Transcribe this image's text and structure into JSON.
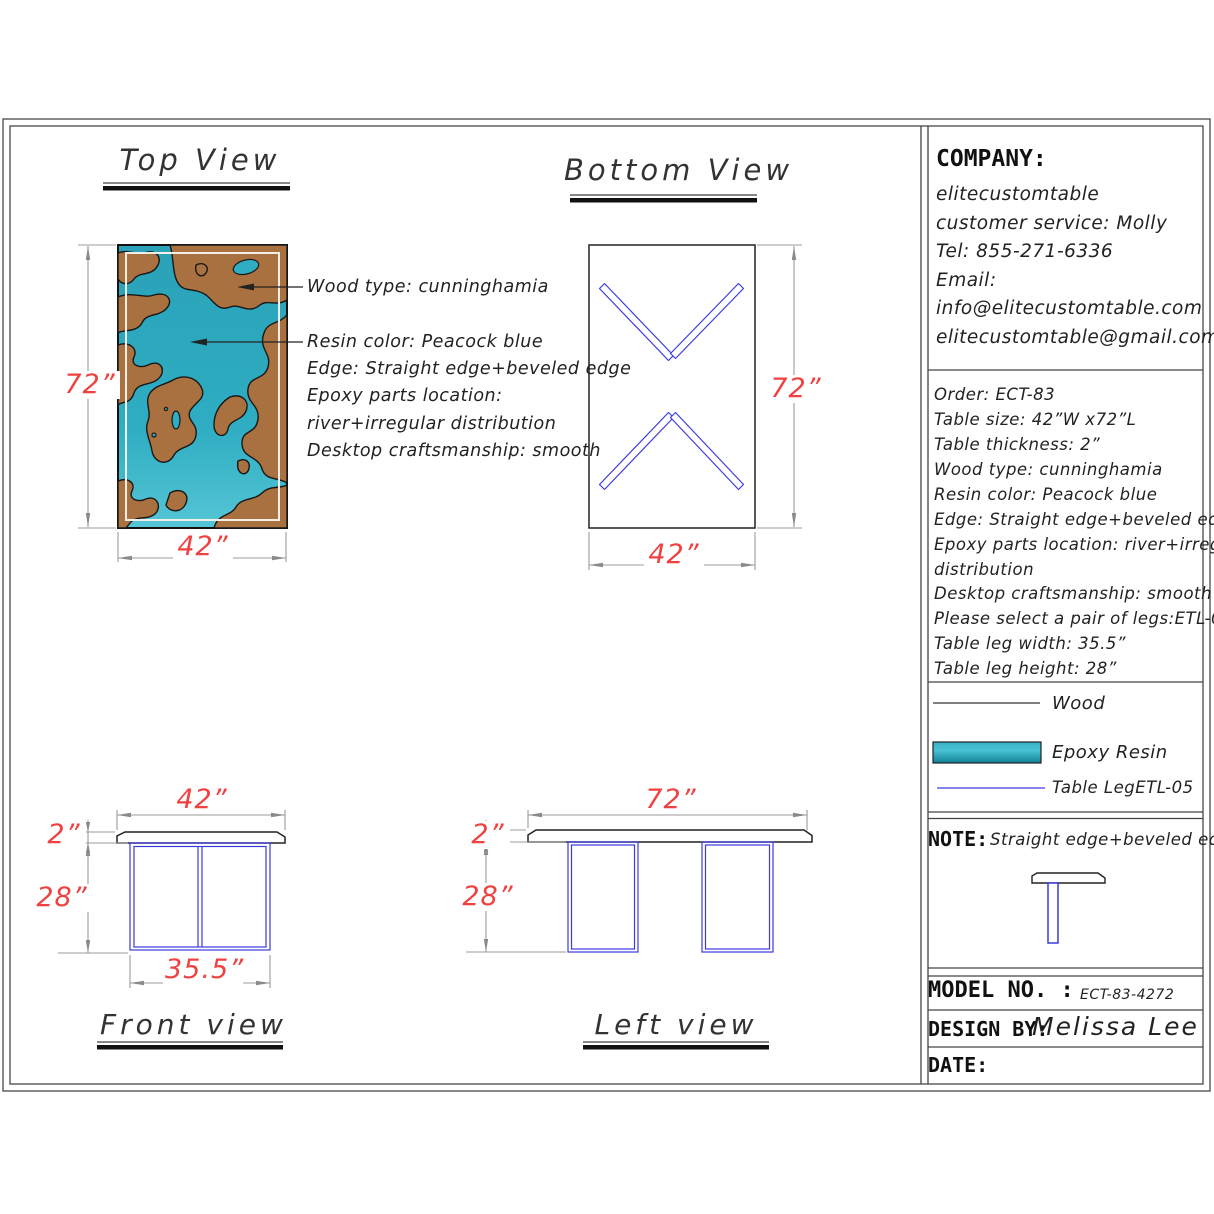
{
  "titles": {
    "top_view": "Top View",
    "bottom_view": "Bottom View",
    "front_view": "Front view",
    "left_view": "Left view"
  },
  "annotations": {
    "wood": "Wood type: cunninghamia",
    "lines": [
      "Resin color: Peacock blue",
      "Edge: Straight edge+beveled edge",
      "Epoxy parts location:",
      "river+irregular distribution",
      "Desktop craftsmanship: smooth"
    ]
  },
  "dims": {
    "top_view": {
      "length": "72”",
      "width": "42”"
    },
    "bottom_view": {
      "length": "72”",
      "width": "42”"
    },
    "front_view": {
      "width": "42”",
      "thickness": "2”",
      "leg_height": "28”",
      "leg_width": "35.5”"
    },
    "left_view": {
      "length": "72”",
      "thickness": "2”",
      "leg_height": "28”"
    }
  },
  "company": {
    "label": "COMPANY:",
    "name": "elitecustomtable",
    "service": "customer service: Molly",
    "tel": "Tel: 855-271-6336",
    "email_label": "Email:",
    "email1": "info@elitecustomtable.com",
    "email2": "elitecustomtable@gmail.com"
  },
  "order": {
    "lines": [
      "Order: ECT-83",
      "Table size: 42”W x72”L",
      "Table thickness: 2”",
      "Wood type: cunninghamia",
      "Resin color: Peacock blue",
      "Edge: Straight edge+beveled edge",
      "Epoxy parts location: river+irregular",
      "distribution",
      "Desktop craftsmanship: smooth",
      "Please select a pair of legs:ETL-05",
      "Table leg width: 35.5”",
      "Table leg height: 28”"
    ]
  },
  "legend": {
    "wood": "Wood",
    "epoxy": "Epoxy Resin",
    "leg": "Table LegETL-05"
  },
  "note": {
    "label": "NOTE:",
    "text": "Straight edge+beveled edge"
  },
  "footer": {
    "model_label": "MODEL NO. :",
    "model_value": "ECT-83-4272",
    "design_label": "DESIGN BY:",
    "design_value": "Melissa Lee",
    "date_label": "DATE:"
  },
  "colors": {
    "epoxy_teal": "#2aa7bd",
    "wood_brown": "#a9713f",
    "leg_blue": "#3b3be0",
    "dim_red": "#f04141",
    "dim_gray": "#9b9b9b"
  }
}
